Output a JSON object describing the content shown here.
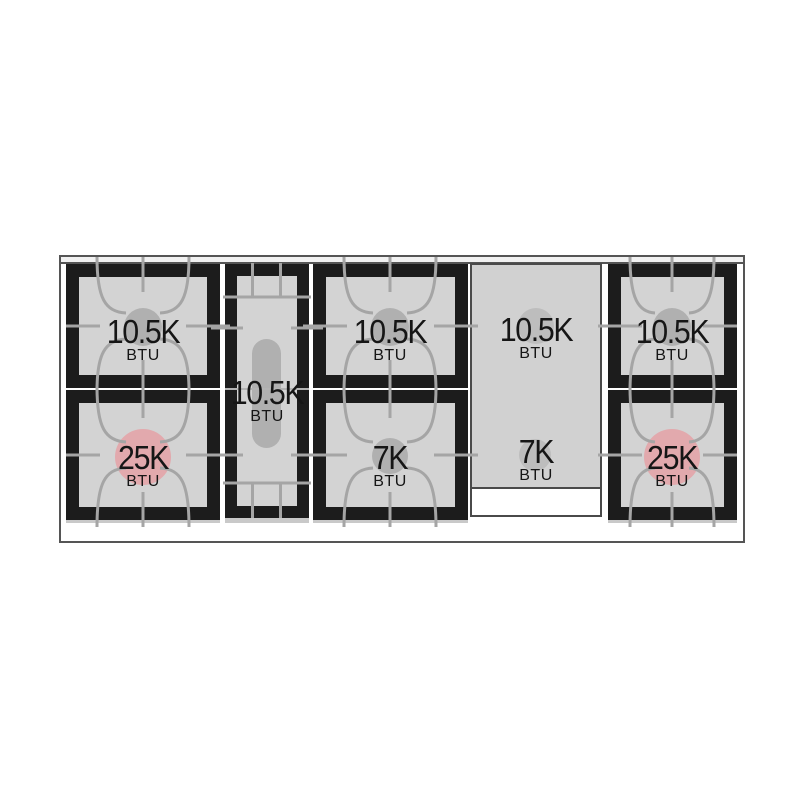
{
  "title": "Gas range cooktop burner BTU layout diagram",
  "colors": {
    "frame_black": "#1c1c1c",
    "surface_gray": "#d3d3d3",
    "griddle_gray": "#d1d1d1",
    "griddle_border": "#4a4a4a",
    "line_gray": "#a5a5a5",
    "seam_gray": "#b4b4b4",
    "burner_gray": "#b0b0b0",
    "griddle_burner_gray": "#bdbdbd",
    "burner_pink": "#e2a9ad",
    "label_text": "#161616",
    "outline_gray": "#555555",
    "back_strip": "#f1f1f1"
  },
  "sections": [
    {
      "name": "left-burner-pair",
      "burners": [
        {
          "value": "10.5K",
          "unit": "BTU"
        },
        {
          "value": "25K",
          "unit": "BTU"
        }
      ]
    },
    {
      "name": "center-oval-burner",
      "burners": [
        {
          "value": "10.5K",
          "unit": "BTU"
        }
      ]
    },
    {
      "name": "middle-burner-pair",
      "burners": [
        {
          "value": "10.5K",
          "unit": "BTU"
        },
        {
          "value": "7K",
          "unit": "BTU"
        }
      ]
    },
    {
      "name": "griddle-zone",
      "burners": [
        {
          "value": "10.5K",
          "unit": "BTU"
        },
        {
          "value": "7K",
          "unit": "BTU"
        }
      ]
    },
    {
      "name": "right-burner-pair",
      "burners": [
        {
          "value": "10.5K",
          "unit": "BTU"
        },
        {
          "value": "25K",
          "unit": "BTU"
        }
      ]
    }
  ]
}
